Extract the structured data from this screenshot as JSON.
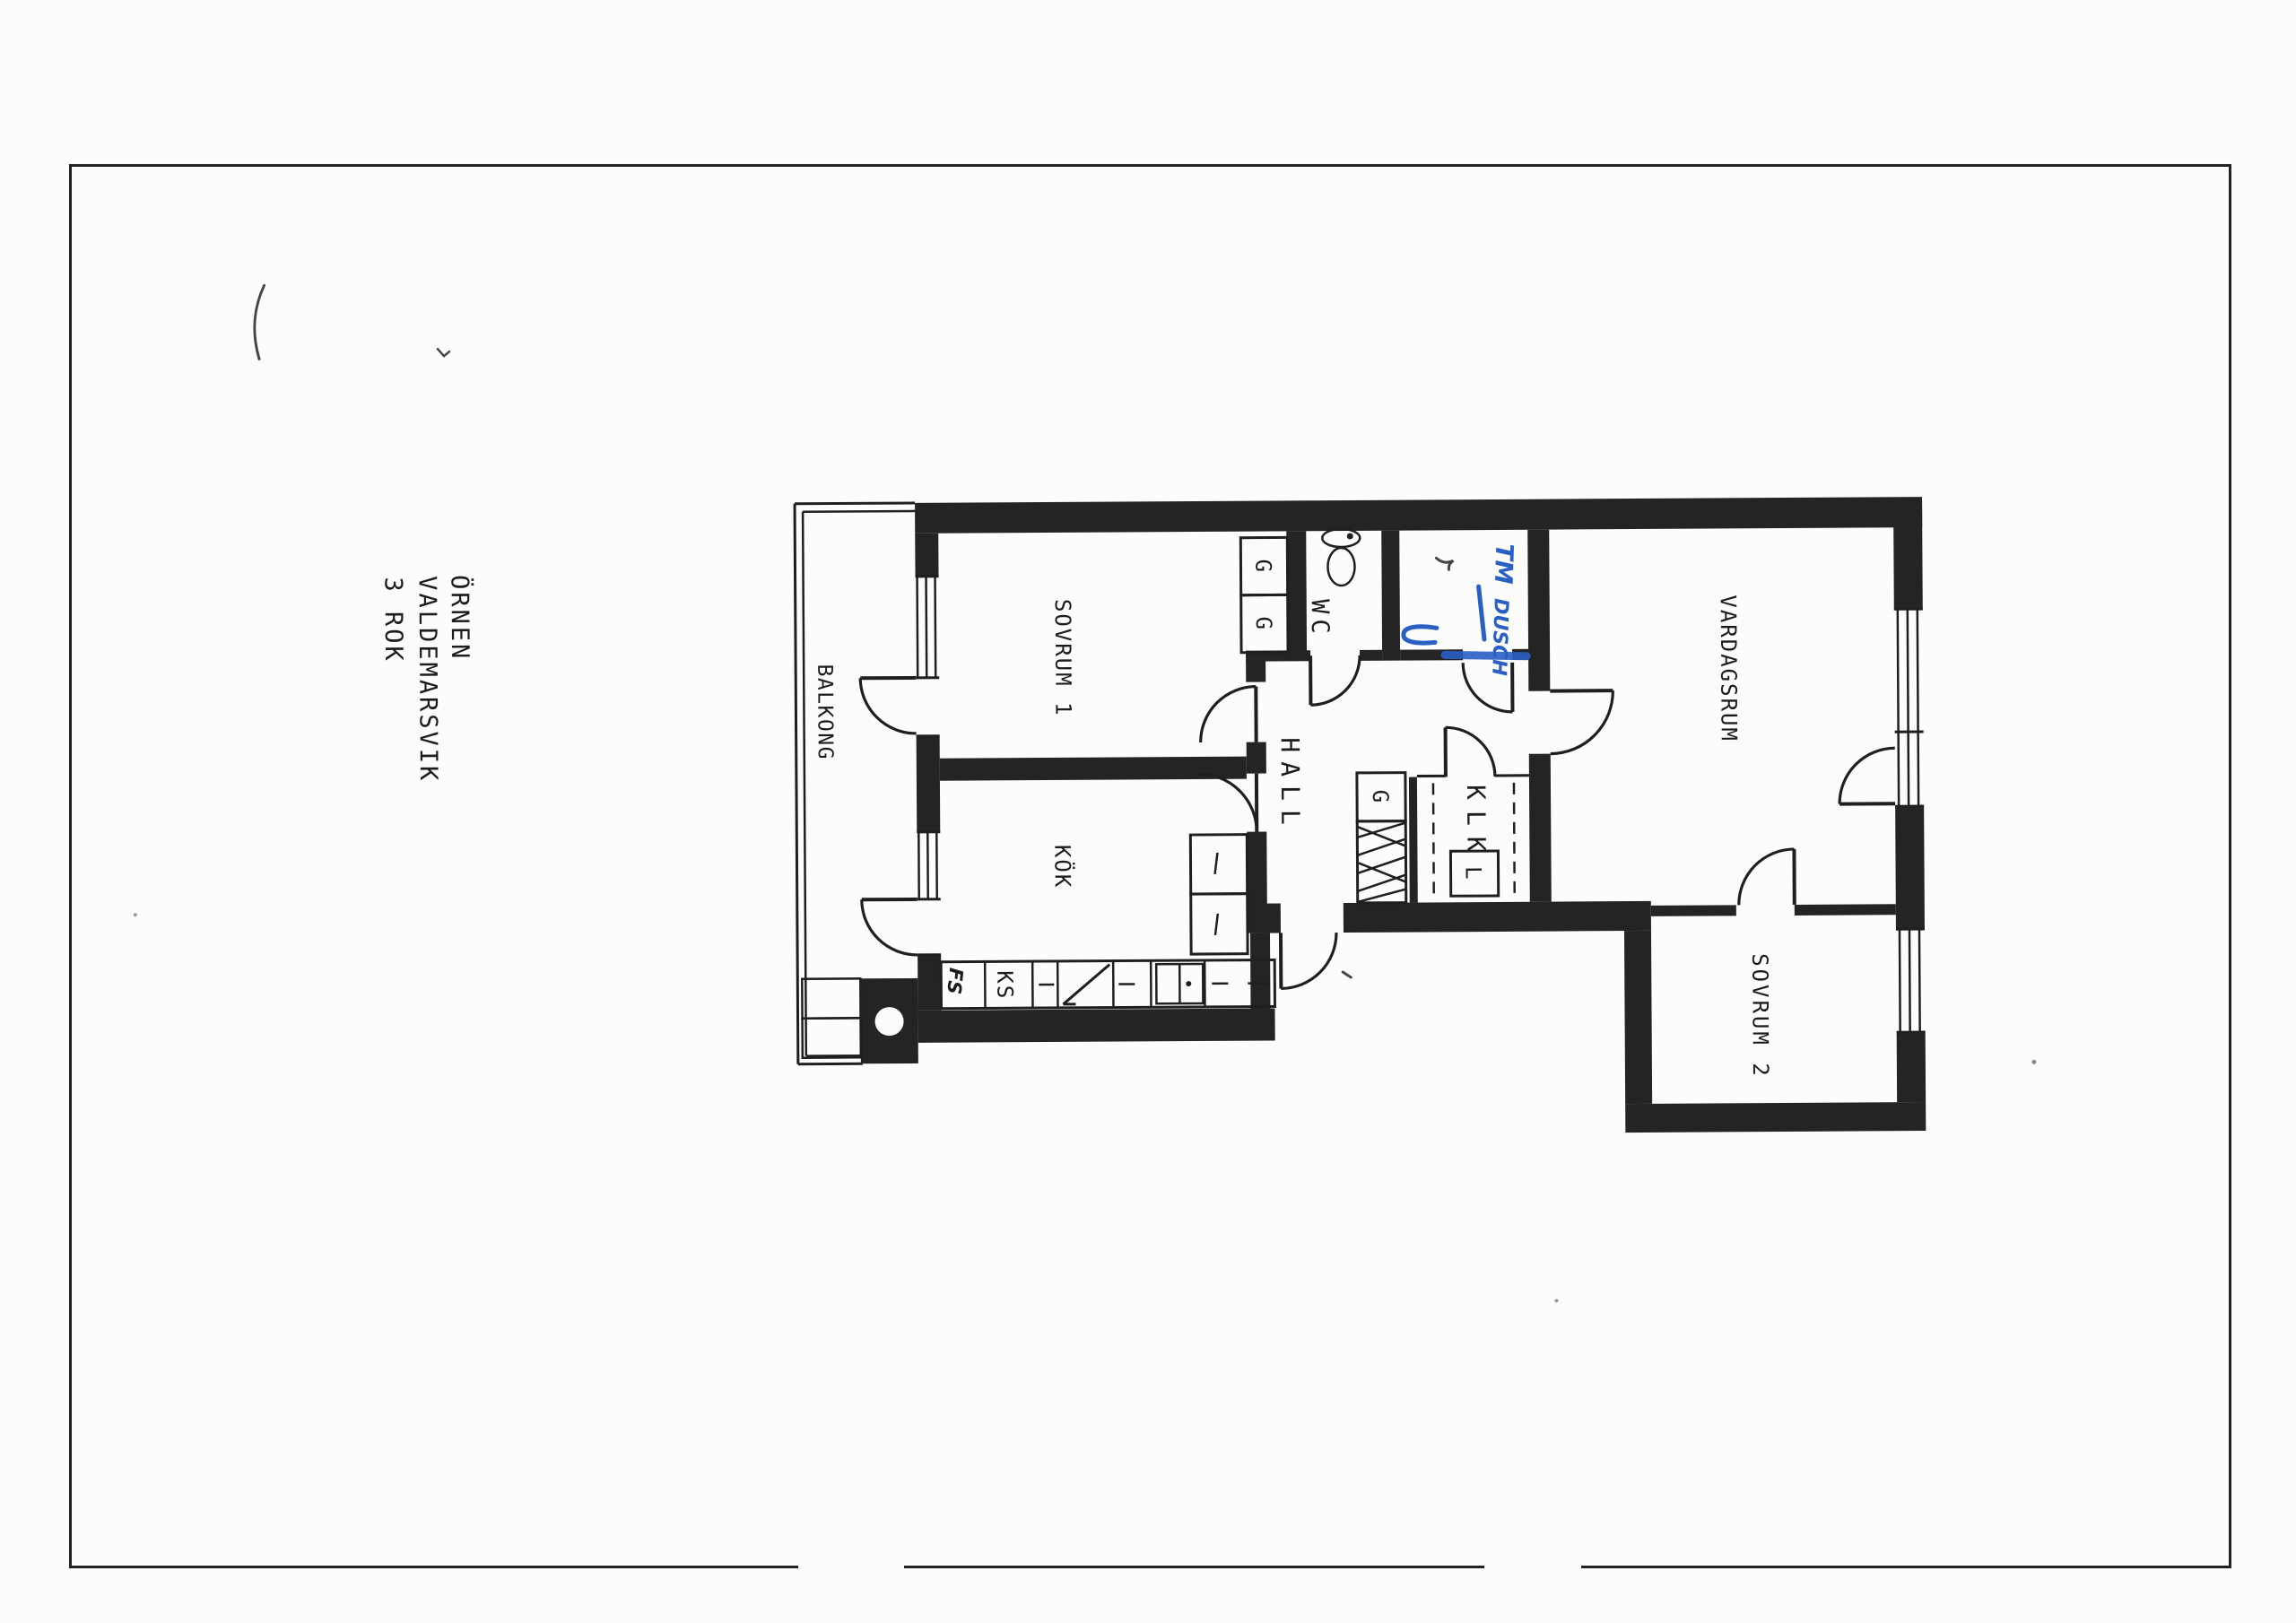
{
  "title_block": {
    "project": "ÖRNEN",
    "location": "VALDEMARSVIK",
    "layout": "3 ROK"
  },
  "rooms": {
    "balcony": "BALKONG",
    "bedroom1": "SOVRUM 1",
    "kitchen": "KÖK",
    "hall": "HALL",
    "wc": "WC",
    "closet_room": "KLK",
    "living_room": "VARDAGSRUM",
    "bedroom2": "SOVRUM 2"
  },
  "fixtures": {
    "wardrobe_1": "G",
    "wardrobe_2": "G",
    "wardrobe_hall": "G",
    "linen_cabinet": "L",
    "fridge": "KS",
    "kitchen_handwritten_note": "FS"
  },
  "annotations": {
    "handwritten_word_1": "TM",
    "handwritten_word_2": "DUSCH"
  },
  "colors": {
    "ink": "#242424",
    "blue_ink": "#2a5fc4",
    "paper": "#fcfcfb"
  }
}
